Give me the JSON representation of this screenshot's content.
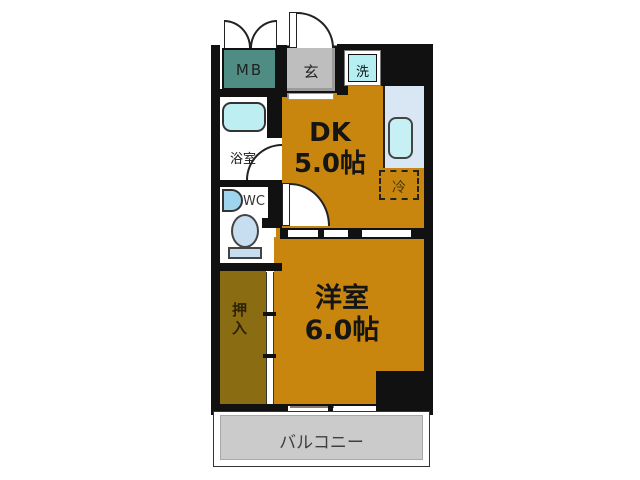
{
  "colors": {
    "wall": "#111111",
    "room": "#c8860e",
    "closet": "#8a6c12",
    "meter_box": "#4f8d84",
    "entrance_floor": "#bebebe",
    "laundry": "#b5eff2",
    "bathtub": "#bdeef2",
    "counter": "#d9e7f5",
    "kitchen_sink": "#c6f0f4",
    "fixture": "#c7ddf0",
    "balcony": "#cbcbcb"
  },
  "rooms": {
    "dk": {
      "name": "DK",
      "size": "5.0帖"
    },
    "living": {
      "name": "洋室",
      "size": "6.0帖"
    },
    "closet": {
      "label": "押入"
    },
    "bathroom": {
      "label": "浴室"
    },
    "wc": {
      "label": "WC"
    },
    "balcony": {
      "label": "バルコニー"
    },
    "entrance": {
      "label": "玄"
    },
    "meter_box": {
      "label": "MB"
    },
    "laundry": {
      "label": "洗"
    },
    "refrigerator": {
      "label": "冷"
    }
  }
}
